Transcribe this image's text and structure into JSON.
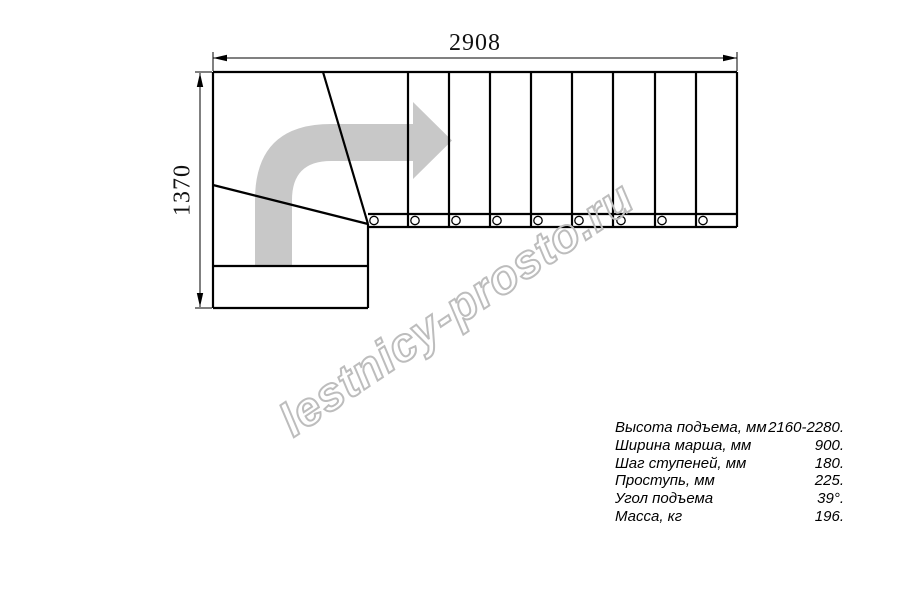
{
  "drawing": {
    "type": "staircase-plan-top-view",
    "dimensions": {
      "width_label": "2908",
      "height_label": "1370"
    },
    "line_color": "#000000",
    "arrow_color": "#c8c8c8",
    "direction_arrow_icon": "curved-right-arrow",
    "straight_steps_count": 9,
    "winder_steps_count": 3,
    "baluster_count": 9
  },
  "watermark": {
    "text": "lestnicy-prosto.ru",
    "stroke_color": "#bdbdbd"
  },
  "specs": {
    "rows": [
      {
        "label": "Высота подъема, мм",
        "value": "2160-2280."
      },
      {
        "label": "Ширина марша, мм",
        "value": "900."
      },
      {
        "label": "Шаг ступеней, мм",
        "value": "180."
      },
      {
        "label": "Проступь, мм",
        "value": "225."
      },
      {
        "label": "Угол подъема",
        "value": "39°."
      },
      {
        "label": "Масса, кг",
        "value": "196."
      }
    ]
  }
}
